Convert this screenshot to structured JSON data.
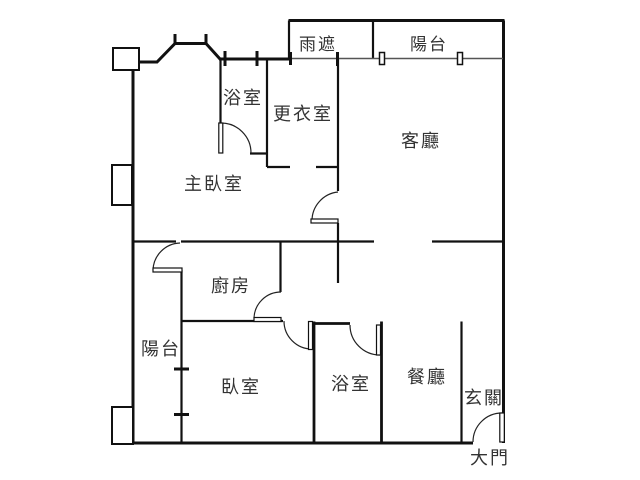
{
  "floor_plan": {
    "background": "#ffffff",
    "wall_color": "#111111",
    "text_color": "#333333",
    "rooms": [
      {
        "id": "rain-shelter",
        "label": "雨遮"
      },
      {
        "id": "balcony-top",
        "label": "陽台"
      },
      {
        "id": "bathroom-upper",
        "label": "浴室"
      },
      {
        "id": "dressing-room",
        "label": "更衣室"
      },
      {
        "id": "living-room",
        "label": "客廳"
      },
      {
        "id": "master-bedroom",
        "label": "主臥室"
      },
      {
        "id": "kitchen",
        "label": "廚房"
      },
      {
        "id": "balcony-left",
        "label": "陽台"
      },
      {
        "id": "bedroom",
        "label": "臥室"
      },
      {
        "id": "bathroom-lower",
        "label": "浴室"
      },
      {
        "id": "dining-room",
        "label": "餐廳"
      },
      {
        "id": "entryway",
        "label": "玄關"
      },
      {
        "id": "main-door",
        "label": "大門"
      }
    ],
    "doors": [
      {
        "id": "bathroom-upper-door"
      },
      {
        "id": "master-bedroom-door"
      },
      {
        "id": "balcony-left-door"
      },
      {
        "id": "kitchen-door"
      },
      {
        "id": "bedroom-door"
      },
      {
        "id": "bathroom-lower-door"
      },
      {
        "id": "main-entry-door"
      }
    ],
    "windows_count": 10
  }
}
